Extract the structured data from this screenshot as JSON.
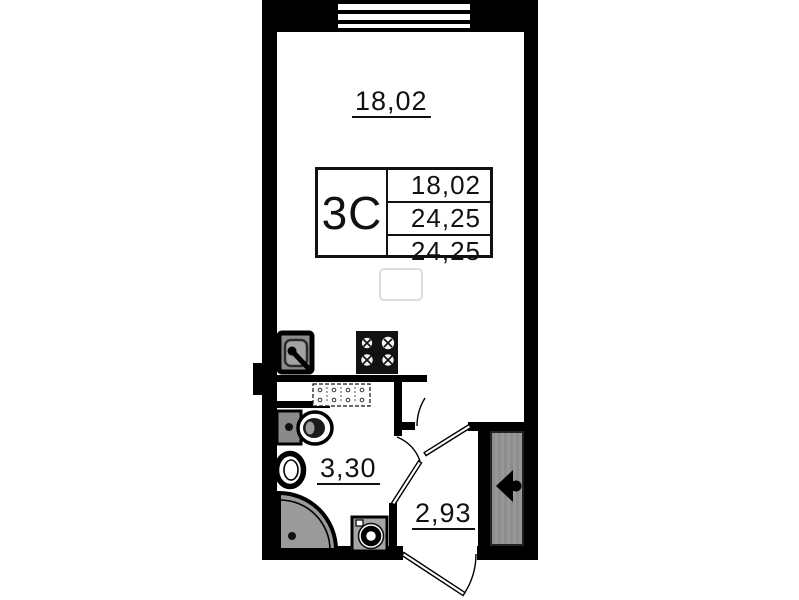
{
  "plan": {
    "title": "studio apartment floor plan",
    "labels": {
      "main_room_area": "18,02",
      "bathroom_area": "3,30",
      "hallway_area": "2,93"
    },
    "info_table": {
      "apartment_type": "3С",
      "rows": [
        "18,02",
        "24,25",
        "24,25"
      ]
    },
    "fixtures": [
      "window",
      "kitchen-sink",
      "stove",
      "ventilation-duct",
      "toilet",
      "washbasin",
      "corner-shower",
      "washing-machine",
      "main-room-door",
      "bathroom-door",
      "entry-door",
      "entry-arrow",
      "closet"
    ],
    "colors": {
      "wall": "#000000",
      "text": "#111111",
      "fixture_gray": "#9a9a9a",
      "closet_gray": "#8f8f8f"
    }
  }
}
